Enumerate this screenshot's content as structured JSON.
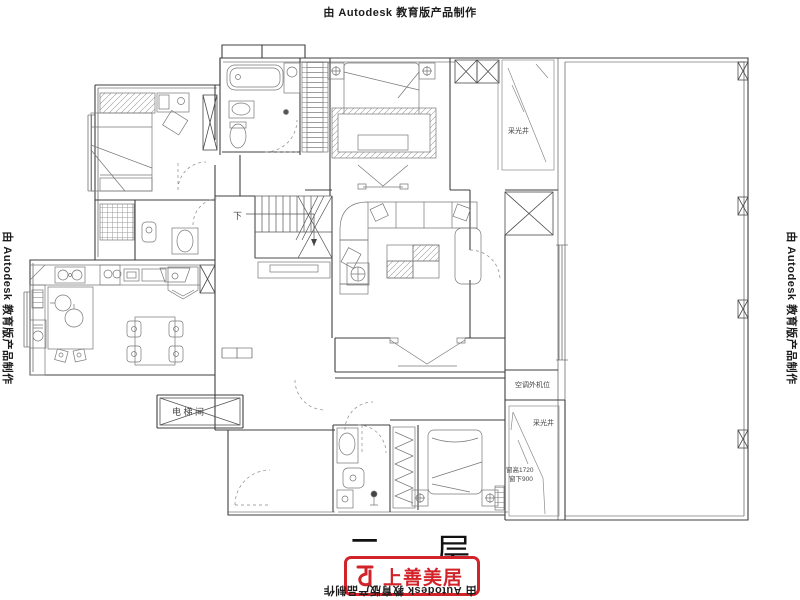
{
  "watermark": {
    "text": "由 Autodesk 教育版产品制作"
  },
  "title": {
    "text": "二 层"
  },
  "logo": {
    "brand": "上善美居",
    "accent_color": "#d2232a",
    "icon": "shangshan-logo-icon"
  },
  "plan": {
    "line_color": "#4a4a4a",
    "labels": {
      "stairs_down": "下",
      "elevator": "电 梯 间",
      "light_well_top": "采光井",
      "light_well_bottom": "采光井",
      "ac_outdoor_unit": "空调外机位",
      "window_height": "窗高1720",
      "window_sill": "窗下900"
    }
  }
}
